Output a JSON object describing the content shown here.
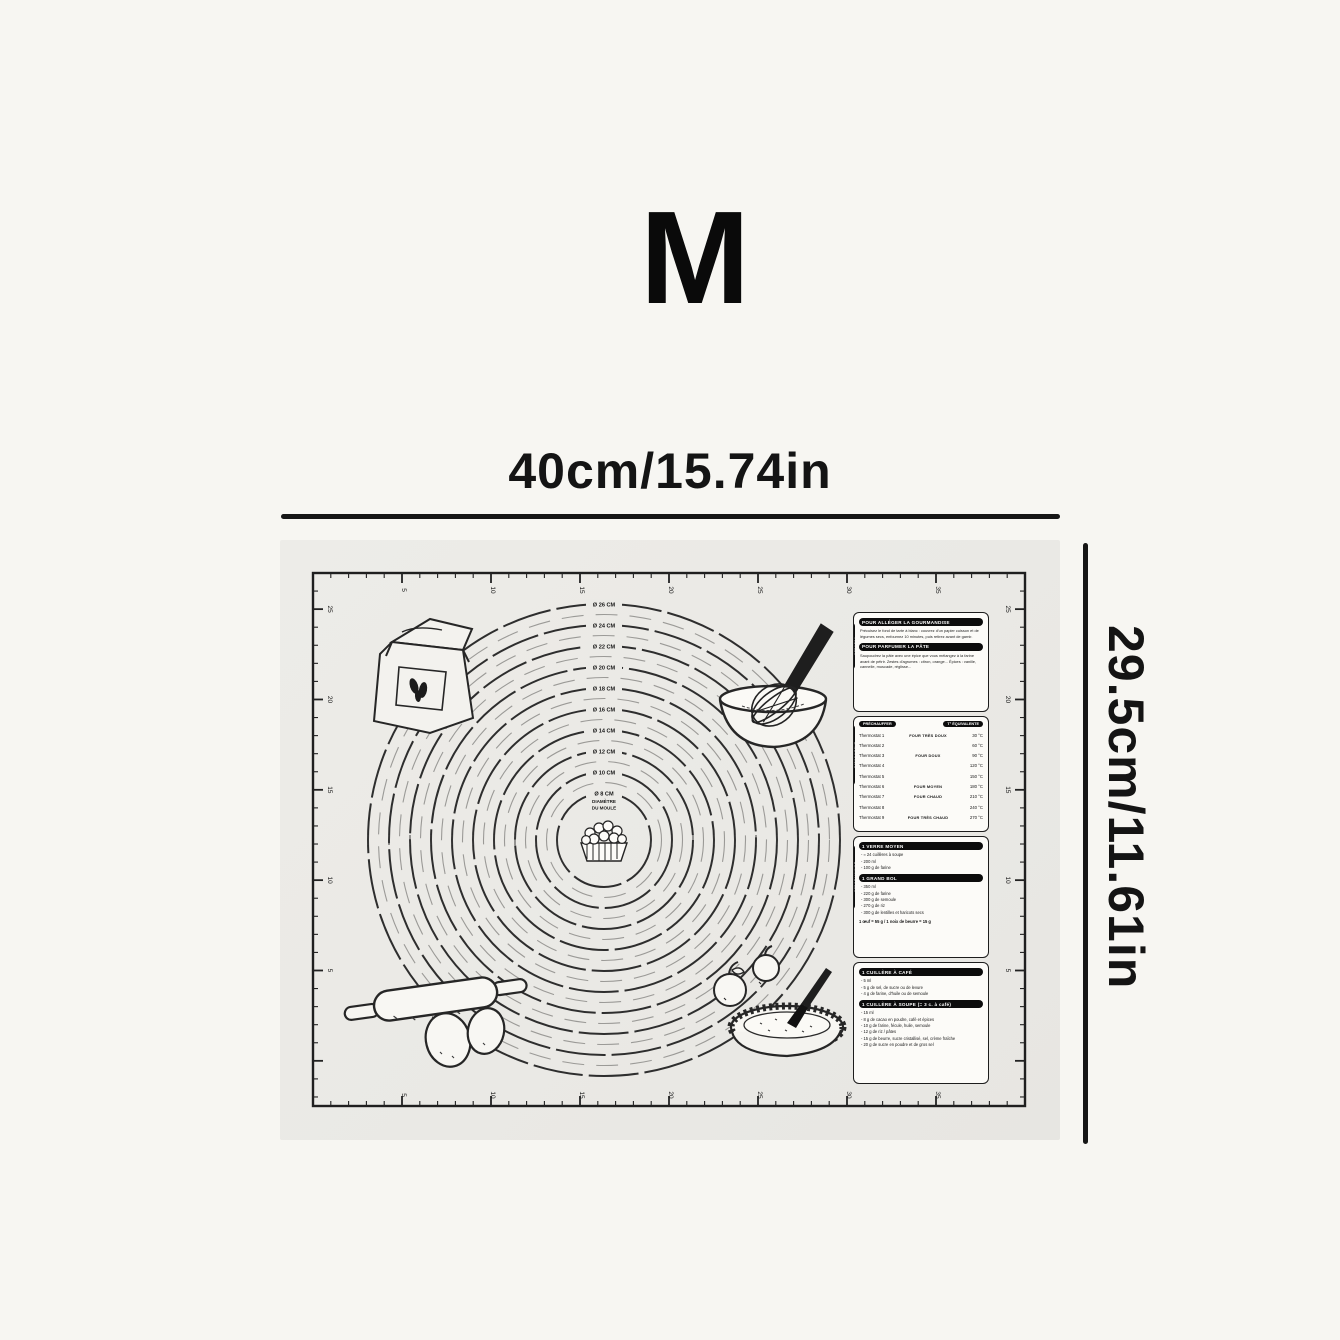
{
  "size_label": "M",
  "dimensions": {
    "width": "40cm/15.74in",
    "height": "29.5cm/11.61in"
  },
  "mat": {
    "ruler": {
      "top": [
        "5",
        "10",
        "15",
        "20",
        "25",
        "30",
        "35"
      ],
      "bottom": [
        "5",
        "10",
        "15",
        "20",
        "25",
        "30",
        "35"
      ],
      "left": [
        "25",
        "20",
        "15",
        "10",
        "5"
      ],
      "right": [
        "25",
        "20",
        "15",
        "10",
        "5"
      ]
    },
    "circles": {
      "labels": [
        "Ø 26 CM",
        "Ø 24 CM",
        "Ø 22 CM",
        "Ø 20 CM",
        "Ø 18 CM",
        "Ø 16 CM",
        "Ø 14 CM",
        "Ø 12 CM",
        "Ø 10 CM",
        "Ø 8 CM"
      ],
      "center_line1": "DIAMÈTRE",
      "center_line2": "DU MOULE"
    },
    "panels": {
      "tips": {
        "tab": "ASTUCES",
        "heading1": "POUR ALLÉGER LA GOURMANDISE",
        "body1": "Précuisez le fond de tarte à blanc : couvrez d'un papier cuisson et de légumes secs, enfournez 10 minutes, puis retirez avant de garnir.",
        "heading2": "POUR PARFUMER LA PÂTE",
        "body2": "Saupoudrez la pâte avec une épice que vous mélangez à la farine avant de pétrir. Zestes d'agrumes : citron, orange... Épices : vanille, cannelle, muscade, réglisse..."
      },
      "thermostat": {
        "tab": "THERMOSTAT",
        "header_left": "PRÉCHAUFFER",
        "header_right": "T° ÉQUIVALENTE",
        "rows": [
          {
            "label": "Thermostat 1",
            "oven": "FOUR TRÈS DOUX",
            "temp": "30 °C"
          },
          {
            "label": "Thermostat 2",
            "oven": "",
            "temp": "60 °C"
          },
          {
            "label": "Thermostat 3",
            "oven": "FOUR DOUX",
            "temp": "90 °C"
          },
          {
            "label": "Thermostat 4",
            "oven": "",
            "temp": "120 °C"
          },
          {
            "label": "Thermostat 5",
            "oven": "",
            "temp": "150 °C"
          },
          {
            "label": "Thermostat 6",
            "oven": "FOUR MOYEN",
            "temp": "180 °C"
          },
          {
            "label": "Thermostat 7",
            "oven": "FOUR CHAUD",
            "temp": "210 °C"
          },
          {
            "label": "Thermostat 8",
            "oven": "",
            "temp": "240 °C"
          },
          {
            "label": "Thermostat 9",
            "oven": "FOUR TRÈS CHAUD",
            "temp": "270 °C"
          }
        ]
      },
      "measures": {
        "tab": "ÉQUIVALENCES",
        "glass_heading": "1 VERRE MOYEN",
        "glass_items": [
          "≈ 24 cuillères à soupe",
          "200 ml",
          "100 g de farine"
        ],
        "bowl_heading": "1 GRAND BOL",
        "bowl_items": [
          "350 ml",
          "220 g de farine",
          "300 g de semoule",
          "270 g de riz",
          "300 g de lentilles et haricots secs"
        ],
        "note": "1 œuf = 55 g / 1 noix de beurre = 15 g"
      },
      "spoons": {
        "tsp_heading": "1 CUILLÈRE À CAFÉ",
        "tsp_items": [
          "5 ml",
          "5 g de sel, de sucre ou de levure",
          "4 g de farine, d'huile ou de semoule"
        ],
        "tbsp_heading": "1 CUILLÈRE À SOUPE (= 3 c. à café)",
        "tbsp_items": [
          "15 ml",
          "8 g de cacao en poudre, café et épices",
          "10 g de farine, fécule, huile, semoule",
          "12 g de riz / pâtes",
          "15 g de beurre, sucre cristallisé, sel, crème fraîche",
          "20 g de sucre en poudre et de gros sel"
        ]
      }
    }
  },
  "colors": {
    "ink": "#1d1d1d",
    "mat_bg": "#ebeae6",
    "page_bg": "#f7f6f2"
  }
}
